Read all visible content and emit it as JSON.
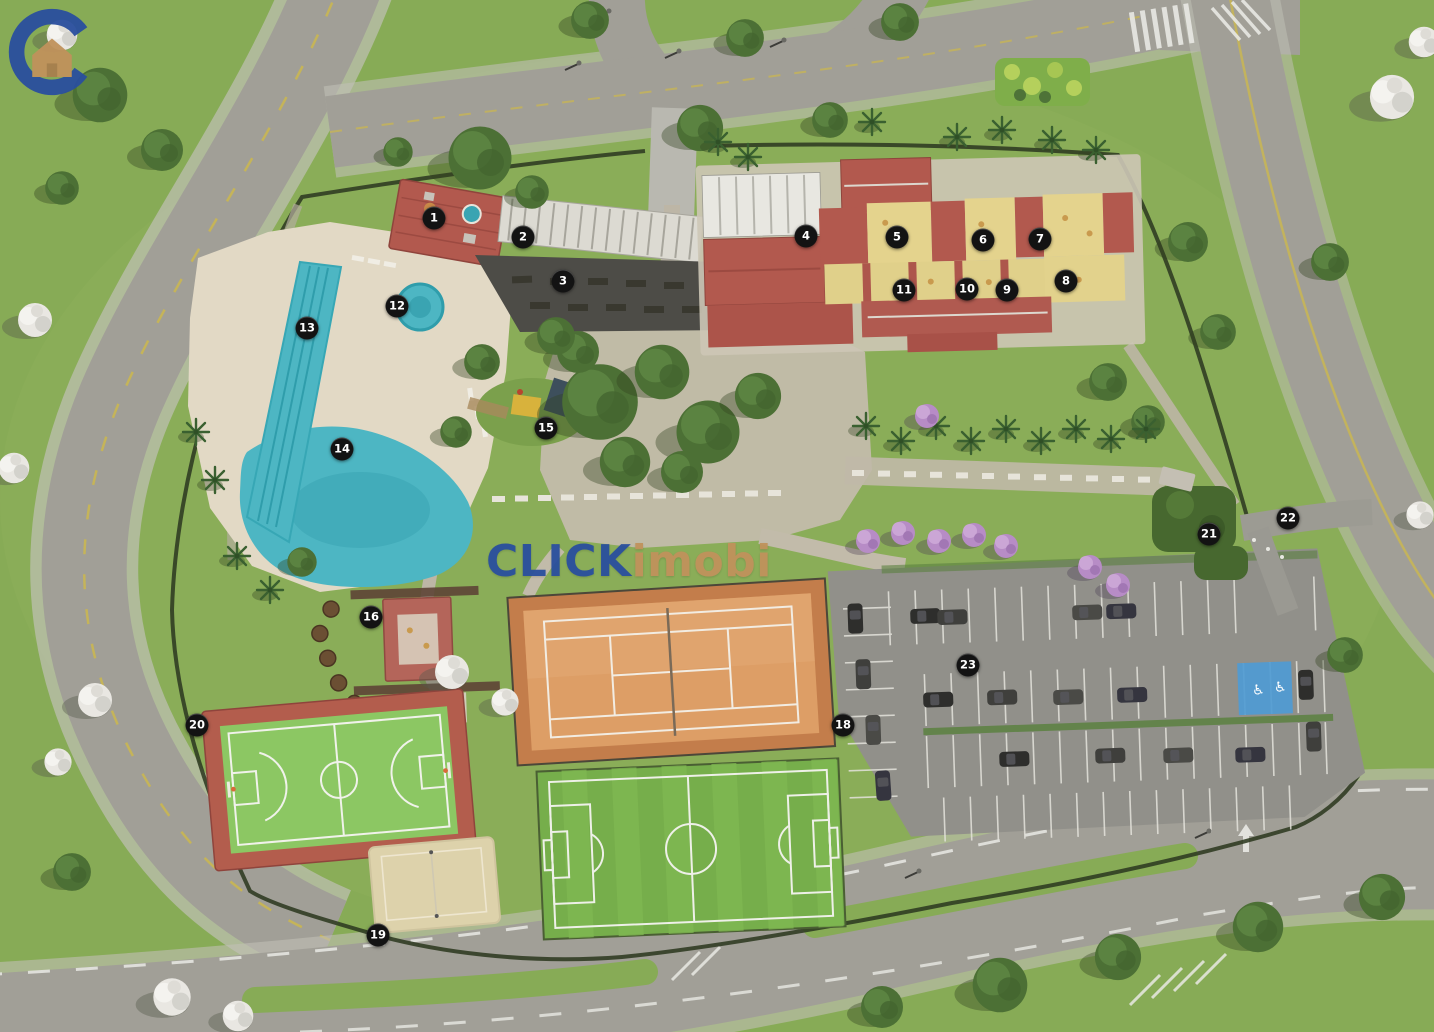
{
  "watermark": {
    "brand_primary": "CLICK",
    "brand_secondary": "imobi"
  },
  "markers": [
    {
      "label": "1",
      "x": 434,
      "y": 218
    },
    {
      "label": "2",
      "x": 523,
      "y": 237
    },
    {
      "label": "3",
      "x": 563,
      "y": 281
    },
    {
      "label": "4",
      "x": 806,
      "y": 236
    },
    {
      "label": "5",
      "x": 897,
      "y": 237
    },
    {
      "label": "6",
      "x": 983,
      "y": 240
    },
    {
      "label": "7",
      "x": 1040,
      "y": 239
    },
    {
      "label": "8",
      "x": 1066,
      "y": 281
    },
    {
      "label": "9",
      "x": 1007,
      "y": 290
    },
    {
      "label": "10",
      "x": 967,
      "y": 289
    },
    {
      "label": "11",
      "x": 904,
      "y": 290
    },
    {
      "label": "12",
      "x": 397,
      "y": 306
    },
    {
      "label": "13",
      "x": 307,
      "y": 328
    },
    {
      "label": "14",
      "x": 342,
      "y": 449
    },
    {
      "label": "15",
      "x": 546,
      "y": 428
    },
    {
      "label": "16",
      "x": 371,
      "y": 617
    },
    {
      "label": "18",
      "x": 843,
      "y": 725
    },
    {
      "label": "19",
      "x": 378,
      "y": 935
    },
    {
      "label": "20",
      "x": 197,
      "y": 725
    },
    {
      "label": "21",
      "x": 1209,
      "y": 534
    },
    {
      "label": "22",
      "x": 1288,
      "y": 518
    },
    {
      "label": "23",
      "x": 968,
      "y": 665
    }
  ],
  "colors": {
    "brand_blue": "#2a4f9e",
    "brand_tan": "#c0925c",
    "lawn": "#87ab56",
    "road": "#a19f97",
    "sidewalk": "#c1c0b6",
    "water": "#4db6c3",
    "deck": "#e2d9c5",
    "roof_red": "#b2594e",
    "courtyard_yellow": "#e4d38d",
    "clay": "#dd9e66",
    "field_green": "#76ae4b",
    "court_green": "#8cc763",
    "court_border_red": "#b35d4d",
    "sand": "#ddd2ab",
    "parking": "#91908a",
    "marking_white": "#e9e9e4",
    "marking_yellow": "#c9b652",
    "hedge": "#2d3a21",
    "accessible_blue": "#4f9bd4",
    "purple_tree": "#b78cc6",
    "marker_bg": "#131313",
    "marker_text": "#ffffff"
  }
}
